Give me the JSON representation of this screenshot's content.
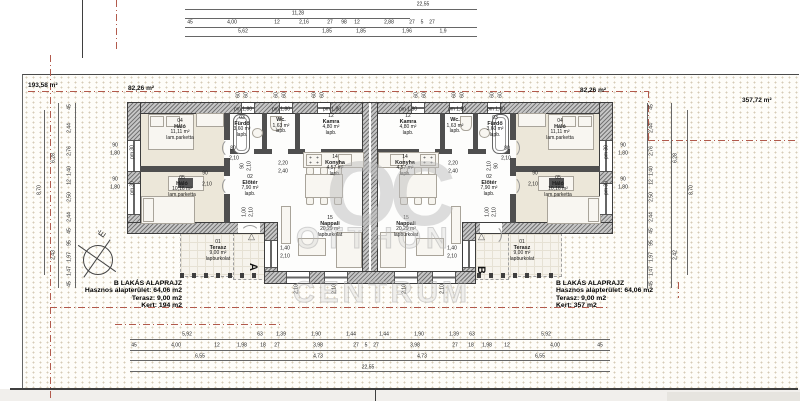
{
  "site": {
    "area_left": "193,58 m²",
    "area_front_left": "82,26 m²",
    "area_front_right": "82,26 m²",
    "area_right": "357,72 m²"
  },
  "legend_left": {
    "title": "B LAKÁS ALAPRAJZ",
    "line1": "Hasznos alapterület: 64,06 m2",
    "line2": "Terasz:  9,00 m2",
    "line3": "Kert: 194 m2"
  },
  "legend_right": {
    "title": "B LAKÁS ALAPRAJZ",
    "line1": "Hasznos alapterület: 64,06 m2",
    "line2": "Terasz:  9,00 m2",
    "line3": "Kert: 357 m2"
  },
  "watermark": {
    "logo": "OC",
    "line1": "OTTHON",
    "line2": "CENTRUM"
  },
  "compass": {
    "north_letter": "É"
  },
  "markers": {
    "section_a": "A",
    "section_b": "B",
    "entry_arrow": "△"
  },
  "rooms": [
    {
      "x": 180,
      "y": 119,
      "b": 1,
      "lines": [
        "04",
        "Háló",
        "11,11 m²",
        "lam.parketta"
      ]
    },
    {
      "x": 242,
      "y": 116,
      "b": 1,
      "lines": [
        "03",
        "Fürdő",
        "3,60 m²",
        "lapb."
      ]
    },
    {
      "x": 281,
      "y": 118,
      "b": 0,
      "lines": [
        "Wc.",
        "1,63 m²",
        "lapb."
      ]
    },
    {
      "x": 331,
      "y": 114,
      "b": 1,
      "lines": [
        "12",
        "Kamra",
        "4,80 m²",
        "lapb."
      ]
    },
    {
      "x": 182,
      "y": 176,
      "b": 1,
      "lines": [
        "05",
        "Háló",
        "10,16 m²",
        "lam.parketta"
      ]
    },
    {
      "x": 250,
      "y": 175,
      "b": 1,
      "lines": [
        "02",
        "Előtér",
        "7,90 m²",
        "lapb."
      ]
    },
    {
      "x": 335,
      "y": 155,
      "b": 1,
      "lines": [
        "14",
        "Konyha",
        "4,57 m²",
        "lapb."
      ]
    },
    {
      "x": 330,
      "y": 216,
      "b": 1,
      "lines": [
        "15",
        "Nappali",
        "20,29 m²",
        "lapburkolat"
      ]
    },
    {
      "x": 218,
      "y": 240,
      "b": 1,
      "lines": [
        "01",
        "Terasz",
        "9,00 m²",
        "lapburkolat"
      ]
    },
    {
      "x": 408,
      "y": 114,
      "b": 1,
      "lines": [
        "12",
        "Kamra",
        "4,80 m²",
        "lapb."
      ]
    },
    {
      "x": 455,
      "y": 118,
      "b": 0,
      "lines": [
        "Wc.",
        "1,63 m²",
        "lapb."
      ]
    },
    {
      "x": 495,
      "y": 116,
      "b": 1,
      "lines": [
        "03",
        "Fürdő",
        "3,60 m²",
        "lapb."
      ]
    },
    {
      "x": 560,
      "y": 119,
      "b": 1,
      "lines": [
        "04",
        "Háló",
        "11,11 m²",
        "lam.parketta"
      ]
    },
    {
      "x": 405,
      "y": 155,
      "b": 1,
      "lines": [
        "14",
        "Konyha",
        "4,57 m²",
        "lapb."
      ]
    },
    {
      "x": 489,
      "y": 175,
      "b": 1,
      "lines": [
        "02",
        "Előtér",
        "7,90 m²",
        "lapb."
      ]
    },
    {
      "x": 558,
      "y": 176,
      "b": 1,
      "lines": [
        "05",
        "Háló",
        "10,16 m²",
        "lam.parketta"
      ]
    },
    {
      "x": 406,
      "y": 216,
      "b": 1,
      "lines": [
        "15",
        "Nappali",
        "20,29 m²",
        "lapburkolat"
      ]
    },
    {
      "x": 522,
      "y": 240,
      "b": 1,
      "lines": [
        "01",
        "Terasz",
        "9,00 m²",
        "lapburkolat"
      ]
    }
  ],
  "dims": [
    {
      "t": "22,55",
      "x": 423,
      "y": 5
    },
    {
      "t": "11,28",
      "x": 298,
      "y": 14
    },
    {
      "t": "45",
      "x": 190,
      "y": 23
    },
    {
      "t": "4,00",
      "x": 232,
      "y": 23
    },
    {
      "t": "12",
      "x": 277,
      "y": 23
    },
    {
      "t": "2,16",
      "x": 304,
      "y": 23
    },
    {
      "t": "27",
      "x": 330,
      "y": 23
    },
    {
      "t": "98",
      "x": 344,
      "y": 23
    },
    {
      "t": "12",
      "x": 357,
      "y": 23
    },
    {
      "t": "2,88",
      "x": 389,
      "y": 23
    },
    {
      "t": "27",
      "x": 412,
      "y": 23
    },
    {
      "t": "5",
      "x": 422,
      "y": 23
    },
    {
      "t": "27",
      "x": 432,
      "y": 23
    },
    {
      "t": "5,62",
      "x": 243,
      "y": 32
    },
    {
      "t": "1,85",
      "x": 327,
      "y": 32
    },
    {
      "t": "1,85",
      "x": 361,
      "y": 32
    },
    {
      "t": "1,96",
      "x": 407,
      "y": 32
    },
    {
      "t": "1,9",
      "x": 443,
      "y": 32
    },
    {
      "t": "5,92",
      "x": 187,
      "y": 335
    },
    {
      "t": "63",
      "x": 260,
      "y": 335
    },
    {
      "t": "1,39",
      "x": 281,
      "y": 335
    },
    {
      "t": "1,90",
      "x": 316,
      "y": 335
    },
    {
      "t": "1,44",
      "x": 351,
      "y": 335
    },
    {
      "t": "1,44",
      "x": 384,
      "y": 335
    },
    {
      "t": "1,90",
      "x": 419,
      "y": 335
    },
    {
      "t": "1,39",
      "x": 454,
      "y": 335
    },
    {
      "t": "63",
      "x": 472,
      "y": 335
    },
    {
      "t": "5,92",
      "x": 546,
      "y": 335
    },
    {
      "t": "45",
      "x": 134,
      "y": 346
    },
    {
      "t": "4,00",
      "x": 176,
      "y": 346
    },
    {
      "t": "12",
      "x": 217,
      "y": 346
    },
    {
      "t": "1,98",
      "x": 242,
      "y": 346
    },
    {
      "t": "18",
      "x": 263,
      "y": 346
    },
    {
      "t": "27",
      "x": 277,
      "y": 346
    },
    {
      "t": "3,98",
      "x": 318,
      "y": 346
    },
    {
      "t": "27",
      "x": 356,
      "y": 346
    },
    {
      "t": "5",
      "x": 366,
      "y": 346
    },
    {
      "t": "27",
      "x": 376,
      "y": 346
    },
    {
      "t": "3,98",
      "x": 415,
      "y": 346
    },
    {
      "t": "27",
      "x": 455,
      "y": 346
    },
    {
      "t": "18",
      "x": 471,
      "y": 346
    },
    {
      "t": "1,98",
      "x": 487,
      "y": 346
    },
    {
      "t": "12",
      "x": 507,
      "y": 346
    },
    {
      "t": "4,00",
      "x": 555,
      "y": 346
    },
    {
      "t": "45",
      "x": 600,
      "y": 346
    },
    {
      "t": "6,55",
      "x": 200,
      "y": 357
    },
    {
      "t": "4,73",
      "x": 318,
      "y": 357
    },
    {
      "t": "4,73",
      "x": 422,
      "y": 357
    },
    {
      "t": "6,55",
      "x": 540,
      "y": 357
    },
    {
      "t": "22,55",
      "x": 368,
      "y": 368
    },
    {
      "t": "45",
      "x": 70,
      "y": 107,
      "r": 1
    },
    {
      "t": "2,44",
      "x": 70,
      "y": 128,
      "r": 1
    },
    {
      "t": "2,76",
      "x": 70,
      "y": 151,
      "r": 1
    },
    {
      "t": "1,40",
      "x": 70,
      "y": 171,
      "r": 1
    },
    {
      "t": "12",
      "x": 70,
      "y": 182,
      "r": 1
    },
    {
      "t": "2,50",
      "x": 70,
      "y": 197,
      "r": 1
    },
    {
      "t": "2,44",
      "x": 70,
      "y": 217,
      "r": 1
    },
    {
      "t": "45",
      "x": 70,
      "y": 231,
      "r": 1
    },
    {
      "t": "95",
      "x": 70,
      "y": 243,
      "r": 1
    },
    {
      "t": "1,97",
      "x": 70,
      "y": 257,
      "r": 1
    },
    {
      "t": "1,47",
      "x": 70,
      "y": 271,
      "r": 1
    },
    {
      "t": "45",
      "x": 70,
      "y": 284,
      "r": 1
    },
    {
      "t": "6,28",
      "x": 54,
      "y": 158,
      "r": 1
    },
    {
      "t": "2,43",
      "x": 54,
      "y": 255,
      "r": 1
    },
    {
      "t": "8,70",
      "x": 40,
      "y": 190,
      "r": 1
    },
    {
      "t": "45",
      "x": 652,
      "y": 107,
      "r": 1
    },
    {
      "t": "2,44",
      "x": 652,
      "y": 128,
      "r": 1
    },
    {
      "t": "2,76",
      "x": 652,
      "y": 151,
      "r": 1
    },
    {
      "t": "1,40",
      "x": 652,
      "y": 171,
      "r": 1
    },
    {
      "t": "12",
      "x": 652,
      "y": 182,
      "r": 1
    },
    {
      "t": "2,50",
      "x": 652,
      "y": 197,
      "r": 1
    },
    {
      "t": "2,44",
      "x": 652,
      "y": 217,
      "r": 1
    },
    {
      "t": "45",
      "x": 652,
      "y": 231,
      "r": 1
    },
    {
      "t": "95",
      "x": 652,
      "y": 243,
      "r": 1
    },
    {
      "t": "1,97",
      "x": 652,
      "y": 257,
      "r": 1
    },
    {
      "t": "1,47",
      "x": 652,
      "y": 271,
      "r": 1
    },
    {
      "t": "45",
      "x": 652,
      "y": 284,
      "r": 1
    },
    {
      "t": "6,28",
      "x": 676,
      "y": 158,
      "r": 1
    },
    {
      "t": "2,42",
      "x": 676,
      "y": 255,
      "r": 1
    },
    {
      "t": "8,70",
      "x": 692,
      "y": 190,
      "r": 1
    },
    {
      "t": "90",
      "x": 115,
      "y": 146
    },
    {
      "t": "1,80",
      "x": 115,
      "y": 154
    },
    {
      "t": "90",
      "x": 115,
      "y": 180
    },
    {
      "t": "1,80",
      "x": 115,
      "y": 188
    },
    {
      "t": "90",
      "x": 623,
      "y": 146
    },
    {
      "t": "1,80",
      "x": 623,
      "y": 154
    },
    {
      "t": "90",
      "x": 623,
      "y": 180
    },
    {
      "t": "1,80",
      "x": 623,
      "y": 188
    },
    {
      "t": "pm 30",
      "x": 133,
      "y": 152,
      "r": 1
    },
    {
      "t": "pm 30",
      "x": 133,
      "y": 188,
      "r": 1
    },
    {
      "t": "pm 30",
      "x": 607,
      "y": 152,
      "r": 1
    },
    {
      "t": "pm 30",
      "x": 607,
      "y": 188,
      "r": 1
    },
    {
      "t": "pm 1,80",
      "x": 243,
      "y": 110
    },
    {
      "t": "pm 1,80",
      "x": 281,
      "y": 110
    },
    {
      "t": "pm 1,80",
      "x": 332,
      "y": 110
    },
    {
      "t": "pm 1,80",
      "x": 408,
      "y": 110
    },
    {
      "t": "pm 1,80",
      "x": 457,
      "y": 110
    },
    {
      "t": "pm 1,80",
      "x": 496,
      "y": 110
    },
    {
      "t": "60",
      "x": 239,
      "y": 95,
      "r": 1
    },
    {
      "t": "60",
      "x": 247,
      "y": 95,
      "r": 1
    },
    {
      "t": "60",
      "x": 277,
      "y": 95,
      "r": 1
    },
    {
      "t": "60",
      "x": 285,
      "y": 95,
      "r": 1
    },
    {
      "t": "60",
      "x": 315,
      "y": 95,
      "r": 1
    },
    {
      "t": "60",
      "x": 323,
      "y": 95,
      "r": 1
    },
    {
      "t": "60",
      "x": 417,
      "y": 95,
      "r": 1
    },
    {
      "t": "60",
      "x": 425,
      "y": 95,
      "r": 1
    },
    {
      "t": "60",
      "x": 455,
      "y": 95,
      "r": 1
    },
    {
      "t": "60",
      "x": 463,
      "y": 95,
      "r": 1
    },
    {
      "t": "60",
      "x": 493,
      "y": 95,
      "r": 1
    },
    {
      "t": "60",
      "x": 501,
      "y": 95,
      "r": 1
    },
    {
      "t": "80",
      "x": 233,
      "y": 149
    },
    {
      "t": "2,10",
      "x": 234,
      "y": 159
    },
    {
      "t": "90",
      "x": 205,
      "y": 174
    },
    {
      "t": "2,10",
      "x": 207,
      "y": 185
    },
    {
      "t": "90",
      "x": 243,
      "y": 166,
      "r": 1
    },
    {
      "t": "2,10",
      "x": 250,
      "y": 166,
      "r": 1
    },
    {
      "t": "2,20",
      "x": 283,
      "y": 164
    },
    {
      "t": "2,40",
      "x": 283,
      "y": 172
    },
    {
      "t": "2,20",
      "x": 453,
      "y": 164
    },
    {
      "t": "2,40",
      "x": 453,
      "y": 172
    },
    {
      "t": "1,00",
      "x": 245,
      "y": 212,
      "r": 1
    },
    {
      "t": "2,10",
      "x": 252,
      "y": 212,
      "r": 1
    },
    {
      "t": "1,00",
      "x": 488,
      "y": 212,
      "r": 1
    },
    {
      "t": "2,10",
      "x": 495,
      "y": 212,
      "r": 1
    },
    {
      "t": "1,40",
      "x": 285,
      "y": 249
    },
    {
      "t": "2,10",
      "x": 285,
      "y": 257
    },
    {
      "t": "1,40",
      "x": 452,
      "y": 249
    },
    {
      "t": "2,10",
      "x": 452,
      "y": 257
    },
    {
      "t": "2,10",
      "x": 297,
      "y": 289,
      "r": 1
    },
    {
      "t": "2,10",
      "x": 335,
      "y": 289,
      "r": 1
    },
    {
      "t": "2,10",
      "x": 405,
      "y": 289,
      "r": 1
    },
    {
      "t": "2,10",
      "x": 443,
      "y": 289,
      "r": 1
    },
    {
      "t": "80",
      "x": 507,
      "y": 149
    },
    {
      "t": "2,10",
      "x": 506,
      "y": 159
    },
    {
      "t": "90",
      "x": 535,
      "y": 174
    },
    {
      "t": "2,10",
      "x": 533,
      "y": 185
    },
    {
      "t": "90",
      "x": 497,
      "y": 166,
      "r": 1
    },
    {
      "t": "2,10",
      "x": 490,
      "y": 166,
      "r": 1
    }
  ]
}
